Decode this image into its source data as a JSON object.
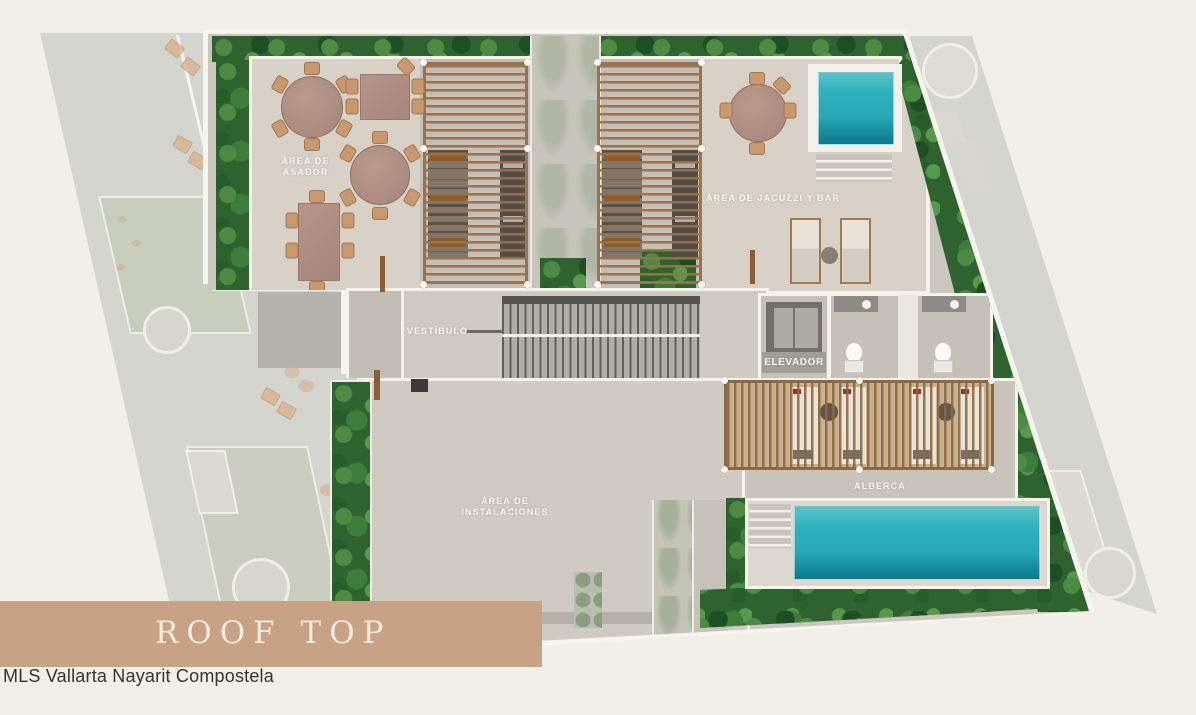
{
  "banner": {
    "title": "ROOF TOP",
    "bg_color": "#c8a284",
    "text_color": "#f3ecdf"
  },
  "footer": {
    "text": "MLS Vallarta Nayarit Compostela"
  },
  "labels": {
    "asador_line1": "ÁREA DE",
    "asador_line2": "ASADOR",
    "jacuzzi_bar": "ÁREA DE JACUZZI Y BAR",
    "vestibulo": "VESTÍBULO",
    "elevador": "ELEVADOR",
    "instalaciones_line1": "ÁREA DE",
    "instalaciones_line2": "INSTALACIONES",
    "alberca": "ALBERCA"
  },
  "colors": {
    "pool_teal": "#2eb1bc",
    "foliage_green": "#2e6330",
    "floor_gray": "#cbc7bf",
    "wood_brown": "#9c7349",
    "background_cream": "#f2efe9"
  }
}
